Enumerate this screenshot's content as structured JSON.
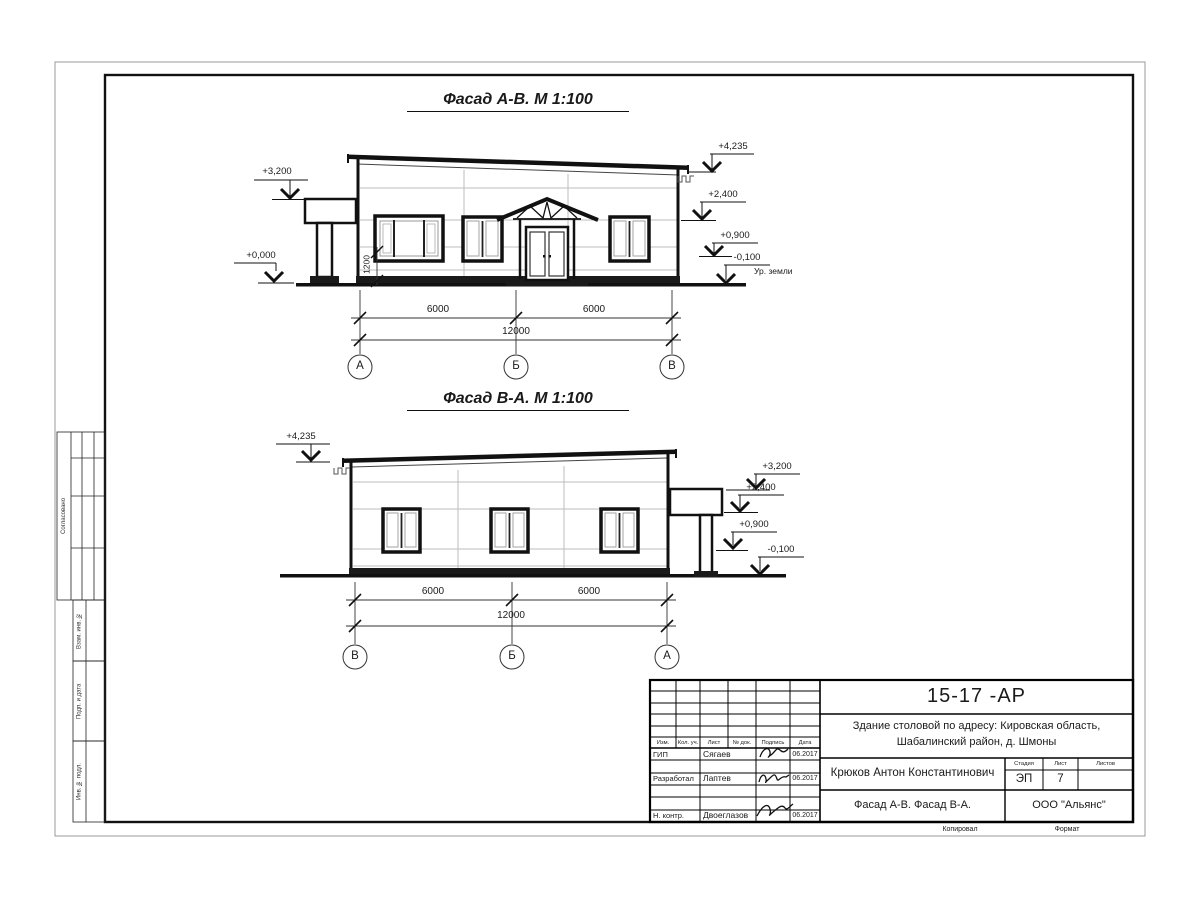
{
  "drawing": {
    "facade1": {
      "title": "Фасад А-В.  М 1:100",
      "elev_3200": "+3,200",
      "elev_0000": "+0,000",
      "elev_4235": "+4,235",
      "elev_2400": "+2,400",
      "elev_0900": "+0,900",
      "elev_m0100": "-0,100",
      "ground_label": "Ур. земли",
      "dim_span1": "6000",
      "dim_span2": "6000",
      "dim_total": "12000",
      "dim_sill": "1200",
      "axes": [
        "А",
        "Б",
        "В"
      ]
    },
    "facade2": {
      "title": "Фасад В-А.  М 1:100",
      "elev_4235": "+4,235",
      "elev_3200": "+3,200",
      "elev_2400": "+2,400",
      "elev_0900": "+0,900",
      "elev_m0100": "-0,100",
      "dim_span1": "6000",
      "dim_span2": "6000",
      "dim_total": "12000",
      "axes": [
        "В",
        "Б",
        "А"
      ]
    }
  },
  "side_strip": {
    "agreed": "Согласовано",
    "vzam": "Взам. инв. №",
    "podp": "Подп. и дата",
    "inv": "Инв. № подл."
  },
  "titleblock": {
    "doc_code": "15-17 -АР",
    "project_line1": "Здание столовой по адресу: Кировская область,",
    "project_line2": "Шабалинский район, д. Шмоны",
    "col_headers": {
      "izm": "Изм.",
      "kol": "Кол. уч.",
      "list": "Лист",
      "ndok": "№ док.",
      "podpis": "Подпись",
      "data": "Дата"
    },
    "rows": [
      {
        "role": "ГИП",
        "name": "Сягаев",
        "date": "06.2017"
      },
      {
        "role": "Разработал",
        "name": "Лаптев",
        "date": "06.2017"
      },
      {
        "role": "Н. контр.",
        "name": "Двоеглазов",
        "date": "06.2017"
      }
    ],
    "author": "Крюков Антон Константинович",
    "stage_header": "Стадия",
    "list_header": "Лист",
    "listov_header": "Листов",
    "stage_value": "ЭП",
    "list_value": "7",
    "drawing_title": "Фасад А-В. Фасад В-А.",
    "company": "ООО \"Альянс\"",
    "copy_label": "Копировал",
    "format_label": "Формат"
  }
}
